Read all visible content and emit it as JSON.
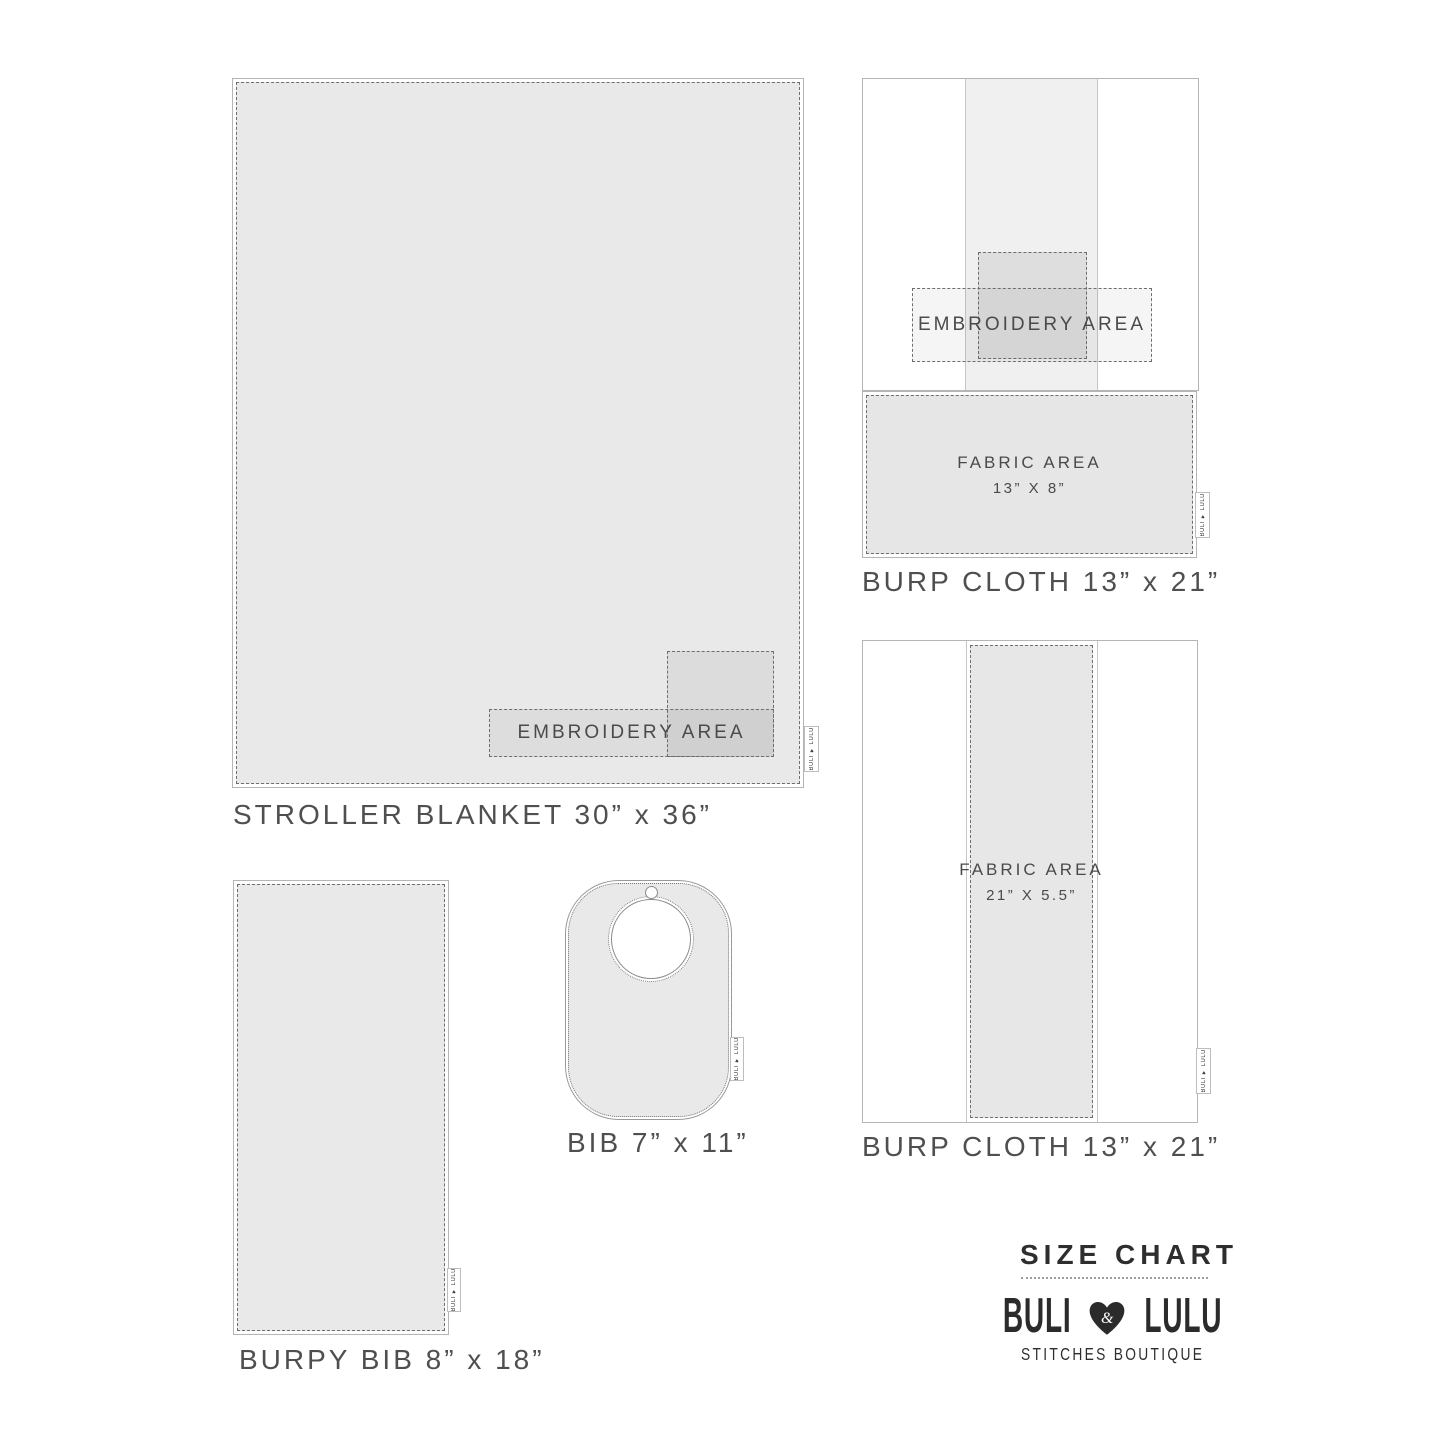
{
  "brand": {
    "size_chart_title": "SIZE CHART",
    "name_left": "BULI",
    "ampersand": "&",
    "name_right": "LULU",
    "subtitle": "STITCHES BOUTIQUE",
    "tag_label": "BULI ♥ LULU"
  },
  "figures": {
    "stroller_blanket": {
      "label": "STROLLER BLANKET 30” x 36”",
      "embroidery_label": "EMBROIDERY AREA"
    },
    "burp_cloth_folded": {
      "label": "BURP CLOTH 13” x 21”",
      "embroidery_label": "EMBROIDERY AREA",
      "fabric_area_line1": "FABRIC AREA",
      "fabric_area_line2": "13” X 8”"
    },
    "burp_cloth_open": {
      "label": "BURP CLOTH 13” x 21”",
      "fabric_area_line1": "FABRIC AREA",
      "fabric_area_line2": "21” X 5.5”"
    },
    "burpy_bib": {
      "label": "BURPY BIB 8” x 18”"
    },
    "bib": {
      "label": "BIB 7” x 11”"
    }
  },
  "colors": {
    "fabric_fill": "#e9e9e9",
    "outline": "#b5b5b5",
    "stitch": "#6e6e6e",
    "label_text": "#4f4f4f",
    "brand_ink": "#2b2b2b"
  }
}
